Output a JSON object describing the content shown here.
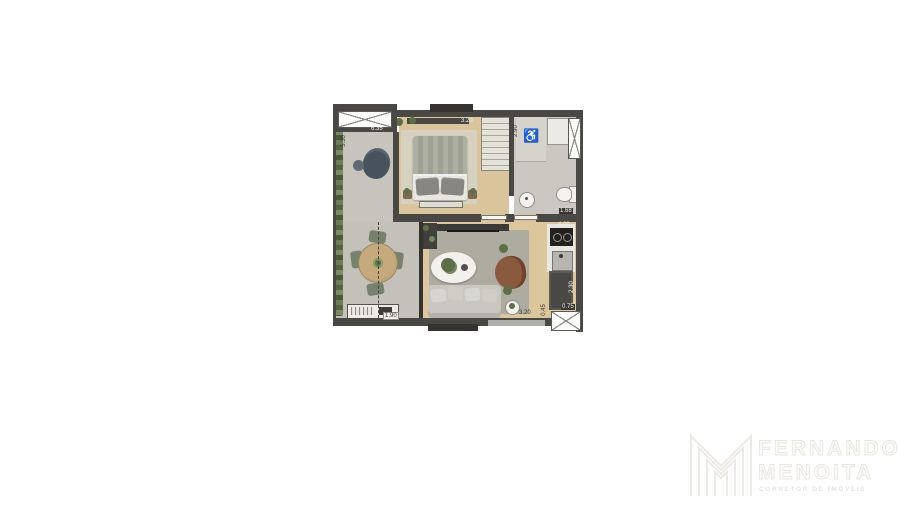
{
  "palette": {
    "wall": "#4a4845",
    "wall_dark": "#35332f",
    "wood_floor": "#dcc79d",
    "concrete_floor": "#c6c4bd",
    "living_rug": "#aeaca0",
    "bedroom_rug": "#d7d1c0",
    "bathroom_floor": "#cbc8c1",
    "plant_green": "#64754f",
    "sofa_gray": "#c9c7c0",
    "armchair_brown": "#8a5a3f",
    "logo_gray": "#e9e7e2"
  },
  "floorplan": {
    "dimensions": {
      "balcony_top": "6.35",
      "balcony_left": "5.30",
      "bedroom_top": "3.20",
      "bathroom_left": "2.90",
      "bathroom_bottom": "1.68",
      "kitchen_top": "4.00",
      "counter_right": "2.30",
      "counter_bottom": "0.75",
      "living_bottom": "3.20",
      "living_bottom_offset": "0.45",
      "dining_bottom": "1.90"
    },
    "icons": {
      "accessible": "♿"
    }
  },
  "logo": {
    "line1": "FERNANDO",
    "line2": "MENOITA",
    "subtitle": "CORRETOR DE IMÓVEIS"
  }
}
